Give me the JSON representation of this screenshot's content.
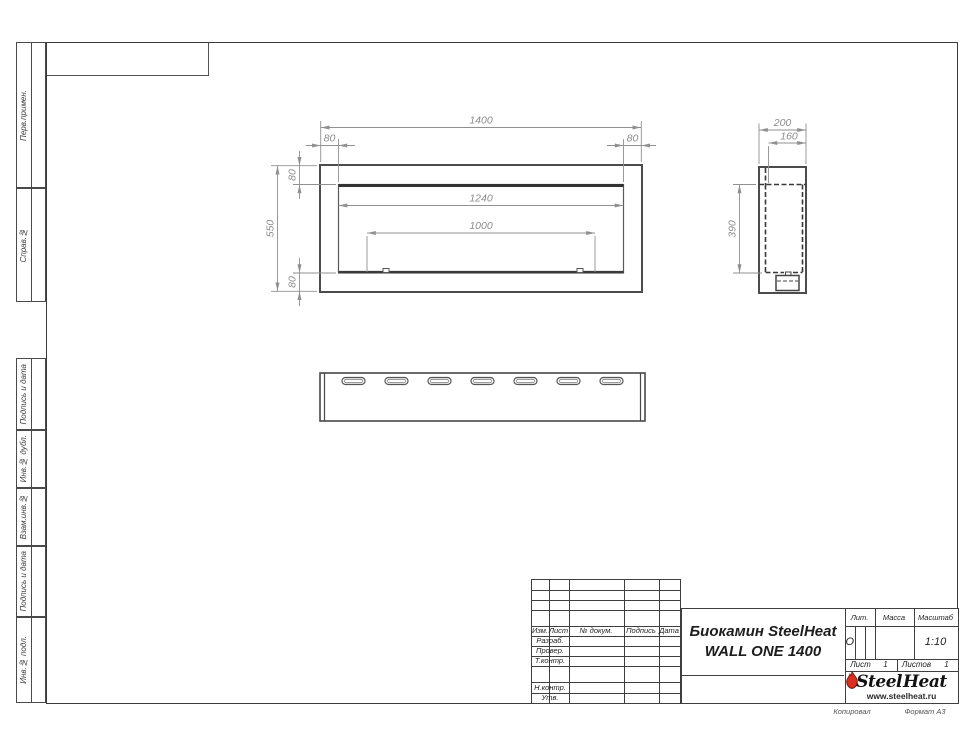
{
  "sheet": {
    "kopiroval": "Копировал",
    "format": "Формат А3"
  },
  "margin_labels": {
    "perv_primen": "Перв.примен.",
    "sprav_no": "Справ.№",
    "podpis_data_1": "Подпись и дата",
    "inv_dubl": "Инв.№ дубл.",
    "vzam_inv": "Взам.инв.№",
    "podpis_data_2": "Подпись и дата",
    "inv_podl": "Инв.№ подл."
  },
  "dims": {
    "front": {
      "width": "1400",
      "margin_left": "80",
      "margin_right": "80",
      "margin_top": "80",
      "margin_bottom": "80",
      "height": "550",
      "opening": "1240",
      "burner": "1000"
    },
    "side": {
      "depth": "200",
      "inner_depth": "160",
      "inner_height": "390"
    }
  },
  "title_block": {
    "header": {
      "izm": "Изм.",
      "list": "Лист",
      "doc": "№ докум.",
      "podpis": "Подпись",
      "data": "Дата"
    },
    "roles": {
      "razrab": "Разраб.",
      "prover": "Провер.",
      "tkontr": "Т.контр.",
      "nkontr": "Н.контр.",
      "utv": "Утв."
    },
    "title_line1": "Биокамин SteelHeat",
    "title_line2": "WALL ONE 1400",
    "lit_label": "Лит.",
    "massa_label": "Масса",
    "masshtab_label": "Масштаб",
    "lit_value": "О",
    "masshtab_value": "1:10",
    "list_label": "Лист",
    "list_value": "1",
    "listov_label": "Листов",
    "listov_value": "1"
  },
  "logo": {
    "steel": "Steel",
    "heat": "Heat",
    "site": "www.steelheat.ru"
  }
}
